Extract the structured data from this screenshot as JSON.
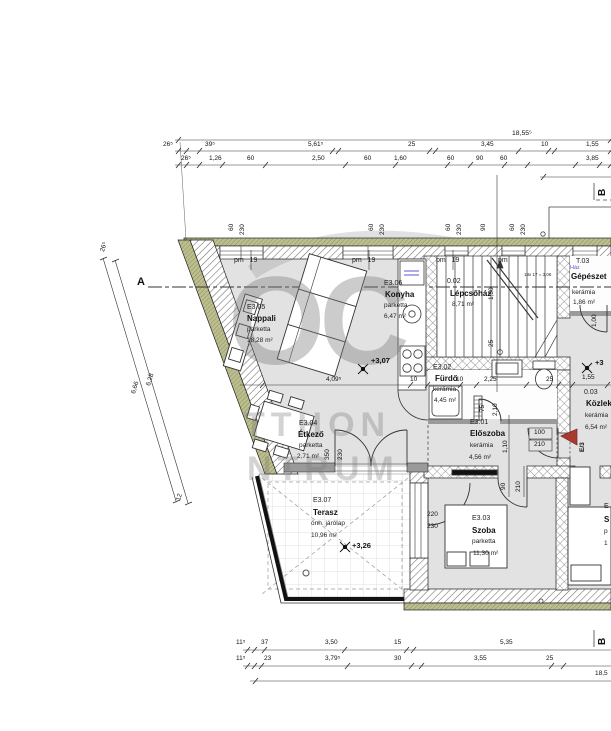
{
  "watermark": {
    "big": "OC",
    "mid": "TTHON",
    "bottom": "NTRUM"
  },
  "section_markers": {
    "a": "A",
    "b": "B"
  },
  "window_label": {
    "pm": "pm",
    "h": "19"
  },
  "window_dim": {
    "w": "60",
    "h": "230",
    "w2": "90"
  },
  "stair": {
    "note": "18x 17 = 3,06",
    "dim1": "1,50",
    "dim2": "25"
  },
  "rooms": {
    "nappali": {
      "code": "E3.05",
      "name": "Nappali",
      "floor": "parketta",
      "area": "18,28 m²"
    },
    "konyha": {
      "code": "E3.06",
      "name": "Konyha",
      "floor": "parketta",
      "area": "6,47 m²"
    },
    "lepcsohaz": {
      "code": "0.02",
      "name": "Lépcsőház",
      "area": "8,71 m²"
    },
    "gepeszet": {
      "code": "T.03",
      "tag": "Ház",
      "name": "Gépészet",
      "floor": "kerámia",
      "area": "1,86 m²"
    },
    "furdo": {
      "code": "E3.02",
      "name": "Fürdő",
      "floor": "kerámia",
      "area": "4,45 m²"
    },
    "eloszoba": {
      "code": "E3.01",
      "name": "Előszoba",
      "floor": "kerámia",
      "area": "4,56 m²"
    },
    "kozlekedo": {
      "code": "0.03",
      "name": "Közlekedő",
      "floor": "kerámia",
      "area": "6,54 m²"
    },
    "etkezo": {
      "code": "E3.04",
      "name": "Étkező",
      "floor": "parketta",
      "area": "2,71 m²"
    },
    "terasz": {
      "code": "E3.07",
      "name": "Terasz",
      "floor": "önh. járólap",
      "area": "10,96 m²"
    },
    "szoba": {
      "code": "E3.03",
      "name": "Szoba",
      "floor": "parketta",
      "area": "11,30 m²"
    }
  },
  "levels": {
    "nappali": "+3,07",
    "terasz": "+3,26",
    "kozlekedo": "+3"
  },
  "entrance": {
    "label": "E/3"
  },
  "doors": {
    "d100": "100",
    "d210": "210",
    "d90": "90",
    "d75": "75",
    "d2_10": "2,10",
    "d1_10": "1,10",
    "d1_00": "1,00",
    "d350": "350",
    "d230": "230",
    "w220": "220",
    "w230": "230"
  },
  "dims": {
    "top_total": "18,55⁵",
    "top_row1": [
      "26⁵",
      "39⁵",
      "5,61⁵",
      "25",
      "3,45",
      "10",
      "1,55"
    ],
    "top_row2": [
      "26⁵",
      "1,26",
      "60",
      "2,50",
      "60",
      "1,60",
      "60",
      "90",
      "60",
      "3,85"
    ],
    "bottom_row1": [
      "11⁵",
      "37",
      "3,50",
      "15",
      "5,35"
    ],
    "bottom_row2": [
      "11⁵",
      "23",
      "3,79⁵",
      "30",
      "3,55",
      "25"
    ],
    "bottom_total": "18,5",
    "left": [
      "26⁵",
      "6,28",
      "6,66",
      "12"
    ],
    "mid": [
      "4,09⁵",
      "10",
      "10",
      "2,25",
      "25",
      "1,55"
    ]
  },
  "right_fragments": {
    "l1": "E",
    "l2": "S",
    "l3": "p",
    "l4": "1"
  },
  "colors": {
    "insulation": "#bcbe8e",
    "wall_hatch": "#666666",
    "floor": "#e2e2e2",
    "entrance_red": "#a93a32",
    "haz_blue": "#5555cc"
  }
}
